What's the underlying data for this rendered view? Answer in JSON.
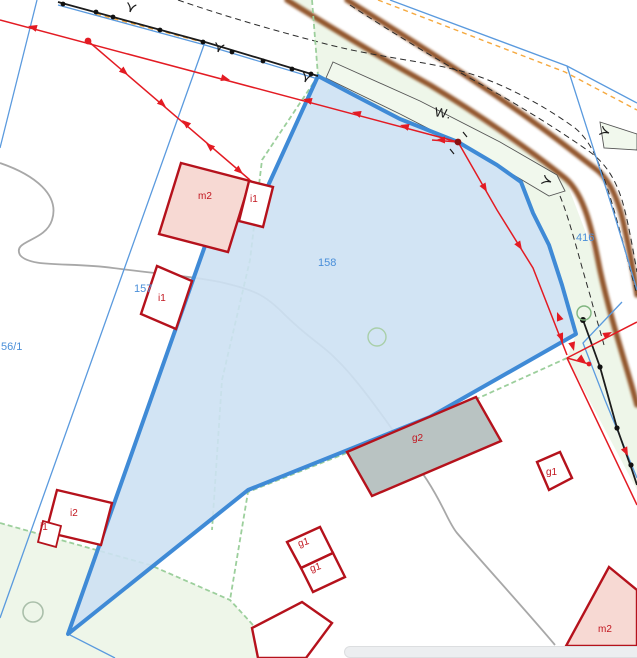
{
  "map": {
    "road_label": "W.",
    "parcel_labels": {
      "p158": "158",
      "p157": "157",
      "p56_1": "56/1",
      "p416": "416"
    },
    "building_labels": {
      "m2_top": "m2",
      "i1_top": "i1",
      "i1_157": "i1",
      "i2": "i2",
      "i1_small": "i1",
      "g2": "g2",
      "g1_right": "g1",
      "g1_upper": "g1",
      "g1_lower": "g1",
      "m2_bottom": "m2"
    },
    "colors": {
      "selected_parcel_fill": "#cde1f3",
      "selected_parcel_border": "#3f8ad6",
      "parcel_line_blue": "#5a9ade",
      "parcel_text_blue": "#4a8fd9",
      "building_red": "#b5121c",
      "building_fill_pink": "#f7d9d3",
      "building_fill_gray": "#b9c3c2",
      "survey_red": "#e31b23",
      "road_brown": "#8a4a1c",
      "vegetation_green_fill": "#eef6e9",
      "vegetation_green_line": "#9ccf9c",
      "orange_dash": "#f5a93f"
    },
    "symbols": [
      "survey-station-icon",
      "boundary-marker-circle-icon",
      "tree-symbol-icon",
      "fence-point-icon"
    ]
  }
}
